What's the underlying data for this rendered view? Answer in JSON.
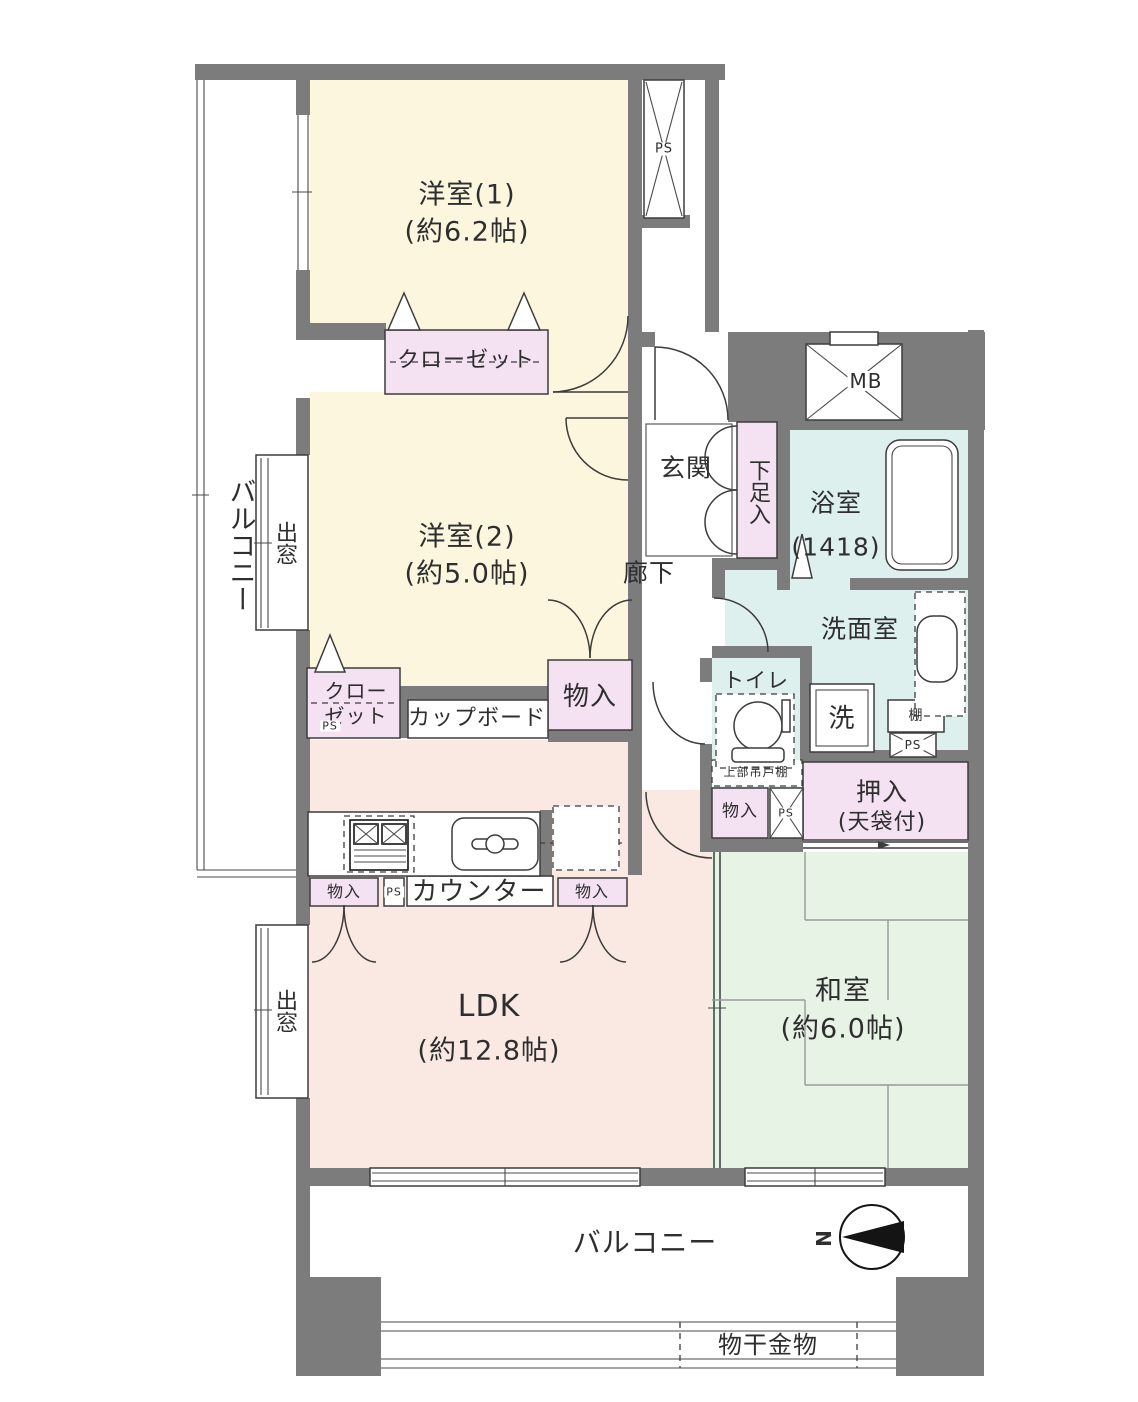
{
  "palette": {
    "wall": "#7c7c7c",
    "western": "#fbf6dd",
    "closet": "#f4e1f1",
    "ldk": "#fae9e3",
    "tatami": "#e7f4e5",
    "wet": "#def0ee"
  },
  "rooms": {
    "western1": {
      "name": "洋室(1)",
      "size": "(約6.2帖)"
    },
    "western2": {
      "name": "洋室(2)",
      "size": "(約5.0帖)"
    },
    "ldk": {
      "name": "LDK",
      "size": "(約12.8帖)"
    },
    "japanese": {
      "name": "和室",
      "size": "(約6.0帖)"
    },
    "bath": {
      "name": "浴室",
      "size": "(1418)"
    },
    "washroom": "洗面室",
    "toilet": "トイレ",
    "entrance": "玄関",
    "hallway": "廊下",
    "balcony_left": "バルコニー",
    "balcony_bottom": "バルコニー"
  },
  "storage": {
    "closet1": "クローゼット",
    "closet2_line1": "クロー",
    "closet2_line2": "ゼット",
    "cupboard": "カップボード",
    "counter": "カウンター",
    "storage": "物入",
    "shoe_box": "下足入",
    "oshiire_line1": "押入",
    "oshiire_line2": "(天袋付)",
    "shelf": "棚",
    "upper_cabinet": "上部吊戸棚",
    "laundry": "洗",
    "bay_window": "出窓",
    "drying_fixture": "物干金物"
  },
  "service": {
    "ps": "PS",
    "mb": "MB",
    "north": "N"
  }
}
